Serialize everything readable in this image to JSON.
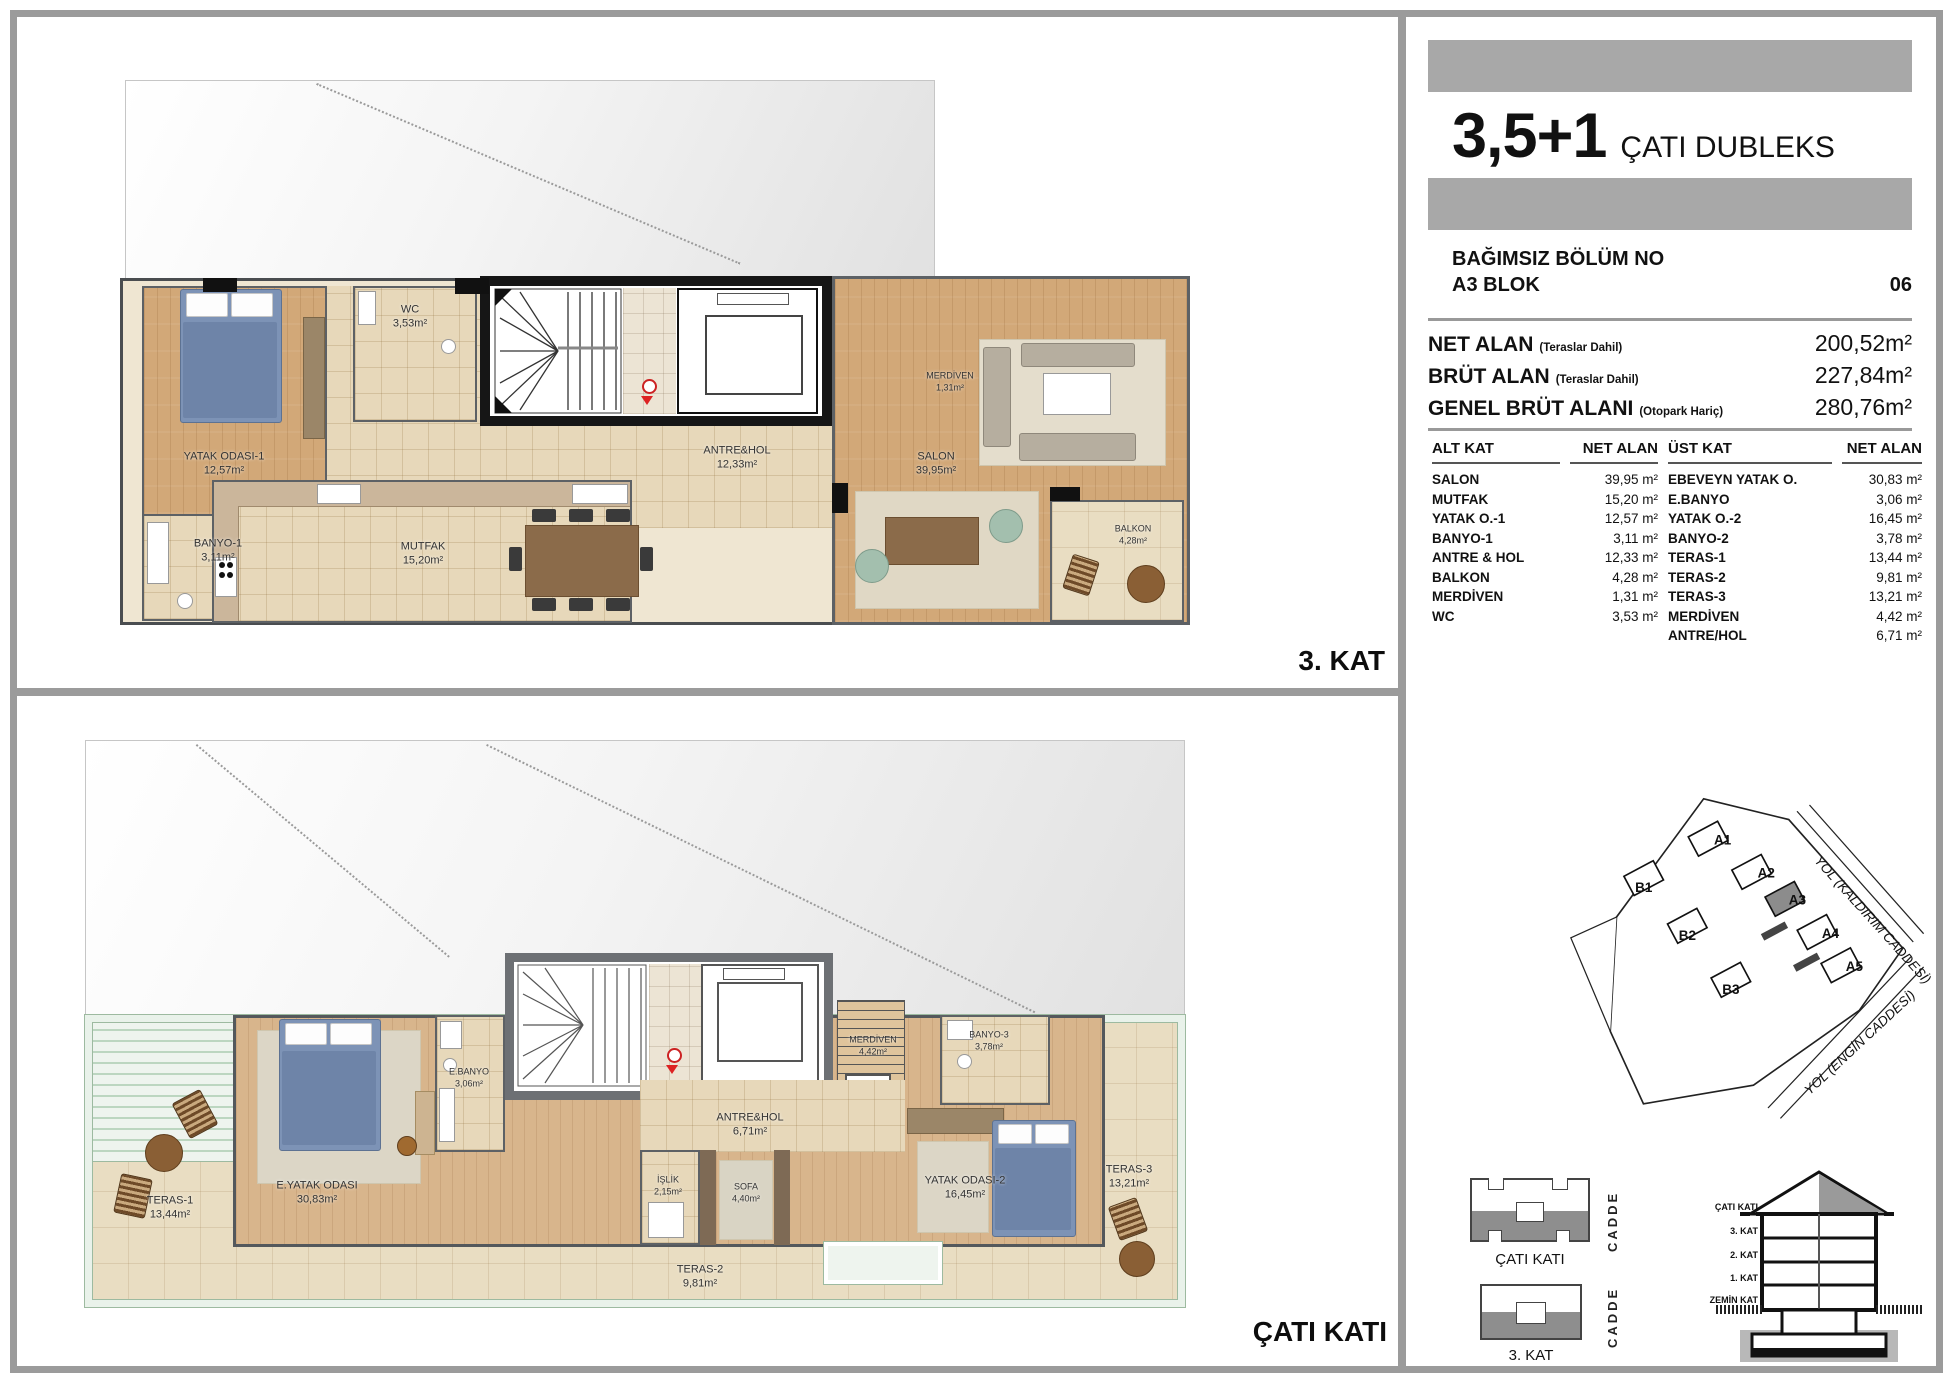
{
  "unit": {
    "title_big": "3,5+1",
    "title_type": "ÇATI DUBLEKS",
    "section_label": "BAĞIMSIZ BÖLÜM NO",
    "block": "A3 BLOK",
    "number": "06"
  },
  "areas": [
    {
      "label": "NET ALAN",
      "note": "(Teraslar Dahil)",
      "value": "200,52m²"
    },
    {
      "label": "BRÜT ALAN",
      "note": "(Teraslar Dahil)",
      "value": "227,84m²"
    },
    {
      "label": "GENEL BRÜT ALANI",
      "note": "(Otopark Hariç)",
      "value": "280,76m²"
    }
  ],
  "area_table": {
    "headers": [
      "ALT KAT",
      "NET ALAN",
      "ÜST KAT",
      "NET ALAN"
    ],
    "alt_kat": [
      {
        "name": "SALON",
        "value": "39,95 m²"
      },
      {
        "name": "MUTFAK",
        "value": "15,20 m²"
      },
      {
        "name": "YATAK O.-1",
        "value": "12,57 m²"
      },
      {
        "name": "BANYO-1",
        "value": "3,11 m²"
      },
      {
        "name": "ANTRE & HOL",
        "value": "12,33 m²"
      },
      {
        "name": "BALKON",
        "value": "4,28 m²"
      },
      {
        "name": "MERDİVEN",
        "value": "1,31 m²"
      },
      {
        "name": "WC",
        "value": "3,53 m²"
      }
    ],
    "ust_kat": [
      {
        "name": "EBEVEYN YATAK O.",
        "value": "30,83 m²"
      },
      {
        "name": "E.BANYO",
        "value": "3,06 m²"
      },
      {
        "name": "YATAK O.-2",
        "value": "16,45 m²"
      },
      {
        "name": "BANYO-2",
        "value": "3,78 m²"
      },
      {
        "name": "TERAS-1",
        "value": "13,44 m²"
      },
      {
        "name": "TERAS-2",
        "value": "9,81 m²"
      },
      {
        "name": "TERAS-3",
        "value": "13,21 m²"
      },
      {
        "name": "MERDİVEN",
        "value": "4,42 m²"
      },
      {
        "name": "ANTRE/HOL",
        "value": "6,71 m²"
      }
    ]
  },
  "floors": {
    "kat3": {
      "tag": "3. KAT",
      "rooms": [
        {
          "name": "YATAK ODASI-1",
          "area": "12,57m²"
        },
        {
          "name": "BANYO-1",
          "area": "3,11m²"
        },
        {
          "name": "WC",
          "area": "3,53m²"
        },
        {
          "name": "MUTFAK",
          "area": "15,20m²"
        },
        {
          "name": "ANTRE&HOL",
          "area": "12,33m²"
        },
        {
          "name": "MERDİVEN",
          "area": "1,31m²"
        },
        {
          "name": "SALON",
          "area": "39,95m²"
        },
        {
          "name": "BALKON",
          "area": "4,28m²"
        }
      ]
    },
    "cati": {
      "tag": "ÇATI KATI",
      "rooms": [
        {
          "name": "TERAS-1",
          "area": "13,44m²"
        },
        {
          "name": "E.YATAK ODASI",
          "area": "30,83m²"
        },
        {
          "name": "E.BANYO",
          "area": "3,06m²"
        },
        {
          "name": "MERDİVEN",
          "area": "4,42m²"
        },
        {
          "name": "ANTRE&HOL",
          "area": "6,71m²"
        },
        {
          "name": "İŞLİK",
          "area": "2,15m²"
        },
        {
          "name": "SOFA",
          "area": "4,40m²"
        },
        {
          "name": "BANYO-3",
          "area": "3,78m²"
        },
        {
          "name": "YATAK ODASI-2",
          "area": "16,45m²"
        },
        {
          "name": "TERAS-3",
          "area": "13,21m²"
        },
        {
          "name": "TERAS-2",
          "area": "9,81m²"
        }
      ]
    }
  },
  "site_plan": {
    "blocks": [
      "A1",
      "A2",
      "A3",
      "A4",
      "A5",
      "B1",
      "B2",
      "B3"
    ],
    "highlighted": "A3",
    "road_top": "YOL (KALDIRIM CADDESİ)",
    "road_bottom": "YOL (ENGİN CADDESİ)"
  },
  "diagrams": {
    "mini_top": "ÇATI KATI",
    "mini_bottom": "3. KAT",
    "street": "CADDE",
    "section_floors": [
      "ÇATI KATI",
      "3. KAT",
      "2. KAT",
      "1. KAT",
      "ZEMİN KAT"
    ]
  },
  "colors": {
    "bar_gray": "#a8a8a8",
    "frame_gray": "#9b9b9b",
    "highlight_block": "#8c8c8c",
    "railing_green": "#9dbaa0",
    "exit_red": "#cc2222"
  }
}
